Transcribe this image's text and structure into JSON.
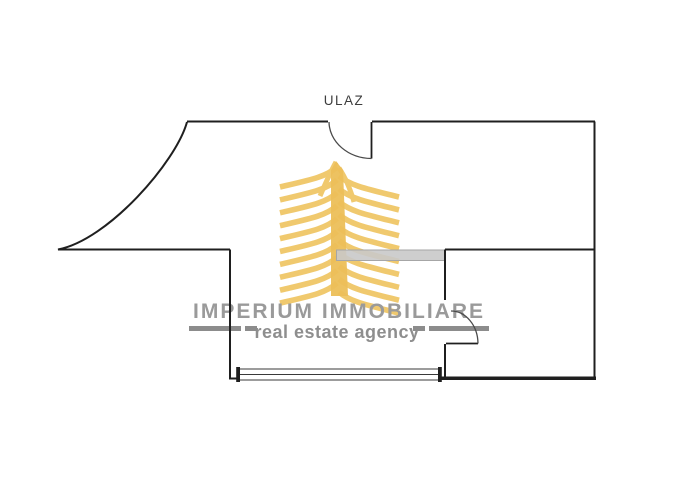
{
  "floorplan": {
    "entrance_label": "ULAZ"
  },
  "watermark": {
    "brand": "IMPERIUM IMMOBILIARE",
    "tagline": "real estate agency"
  },
  "colors": {
    "background": "#ffffff",
    "wall": "#1f1f1f",
    "door_arc": "#4a4a4a",
    "gray_wall_fill": "#c9c9c9",
    "gray_wall_border": "#a6a6a6",
    "logo_yellow": "#f0c96e",
    "logo_yellow_dark": "#ecbf58",
    "brand_text": "#9a9a9a",
    "tagline_text": "#8e8e8e",
    "tagline_bar": "#8c8c8c",
    "entrance_text": "#3d3d3d"
  }
}
